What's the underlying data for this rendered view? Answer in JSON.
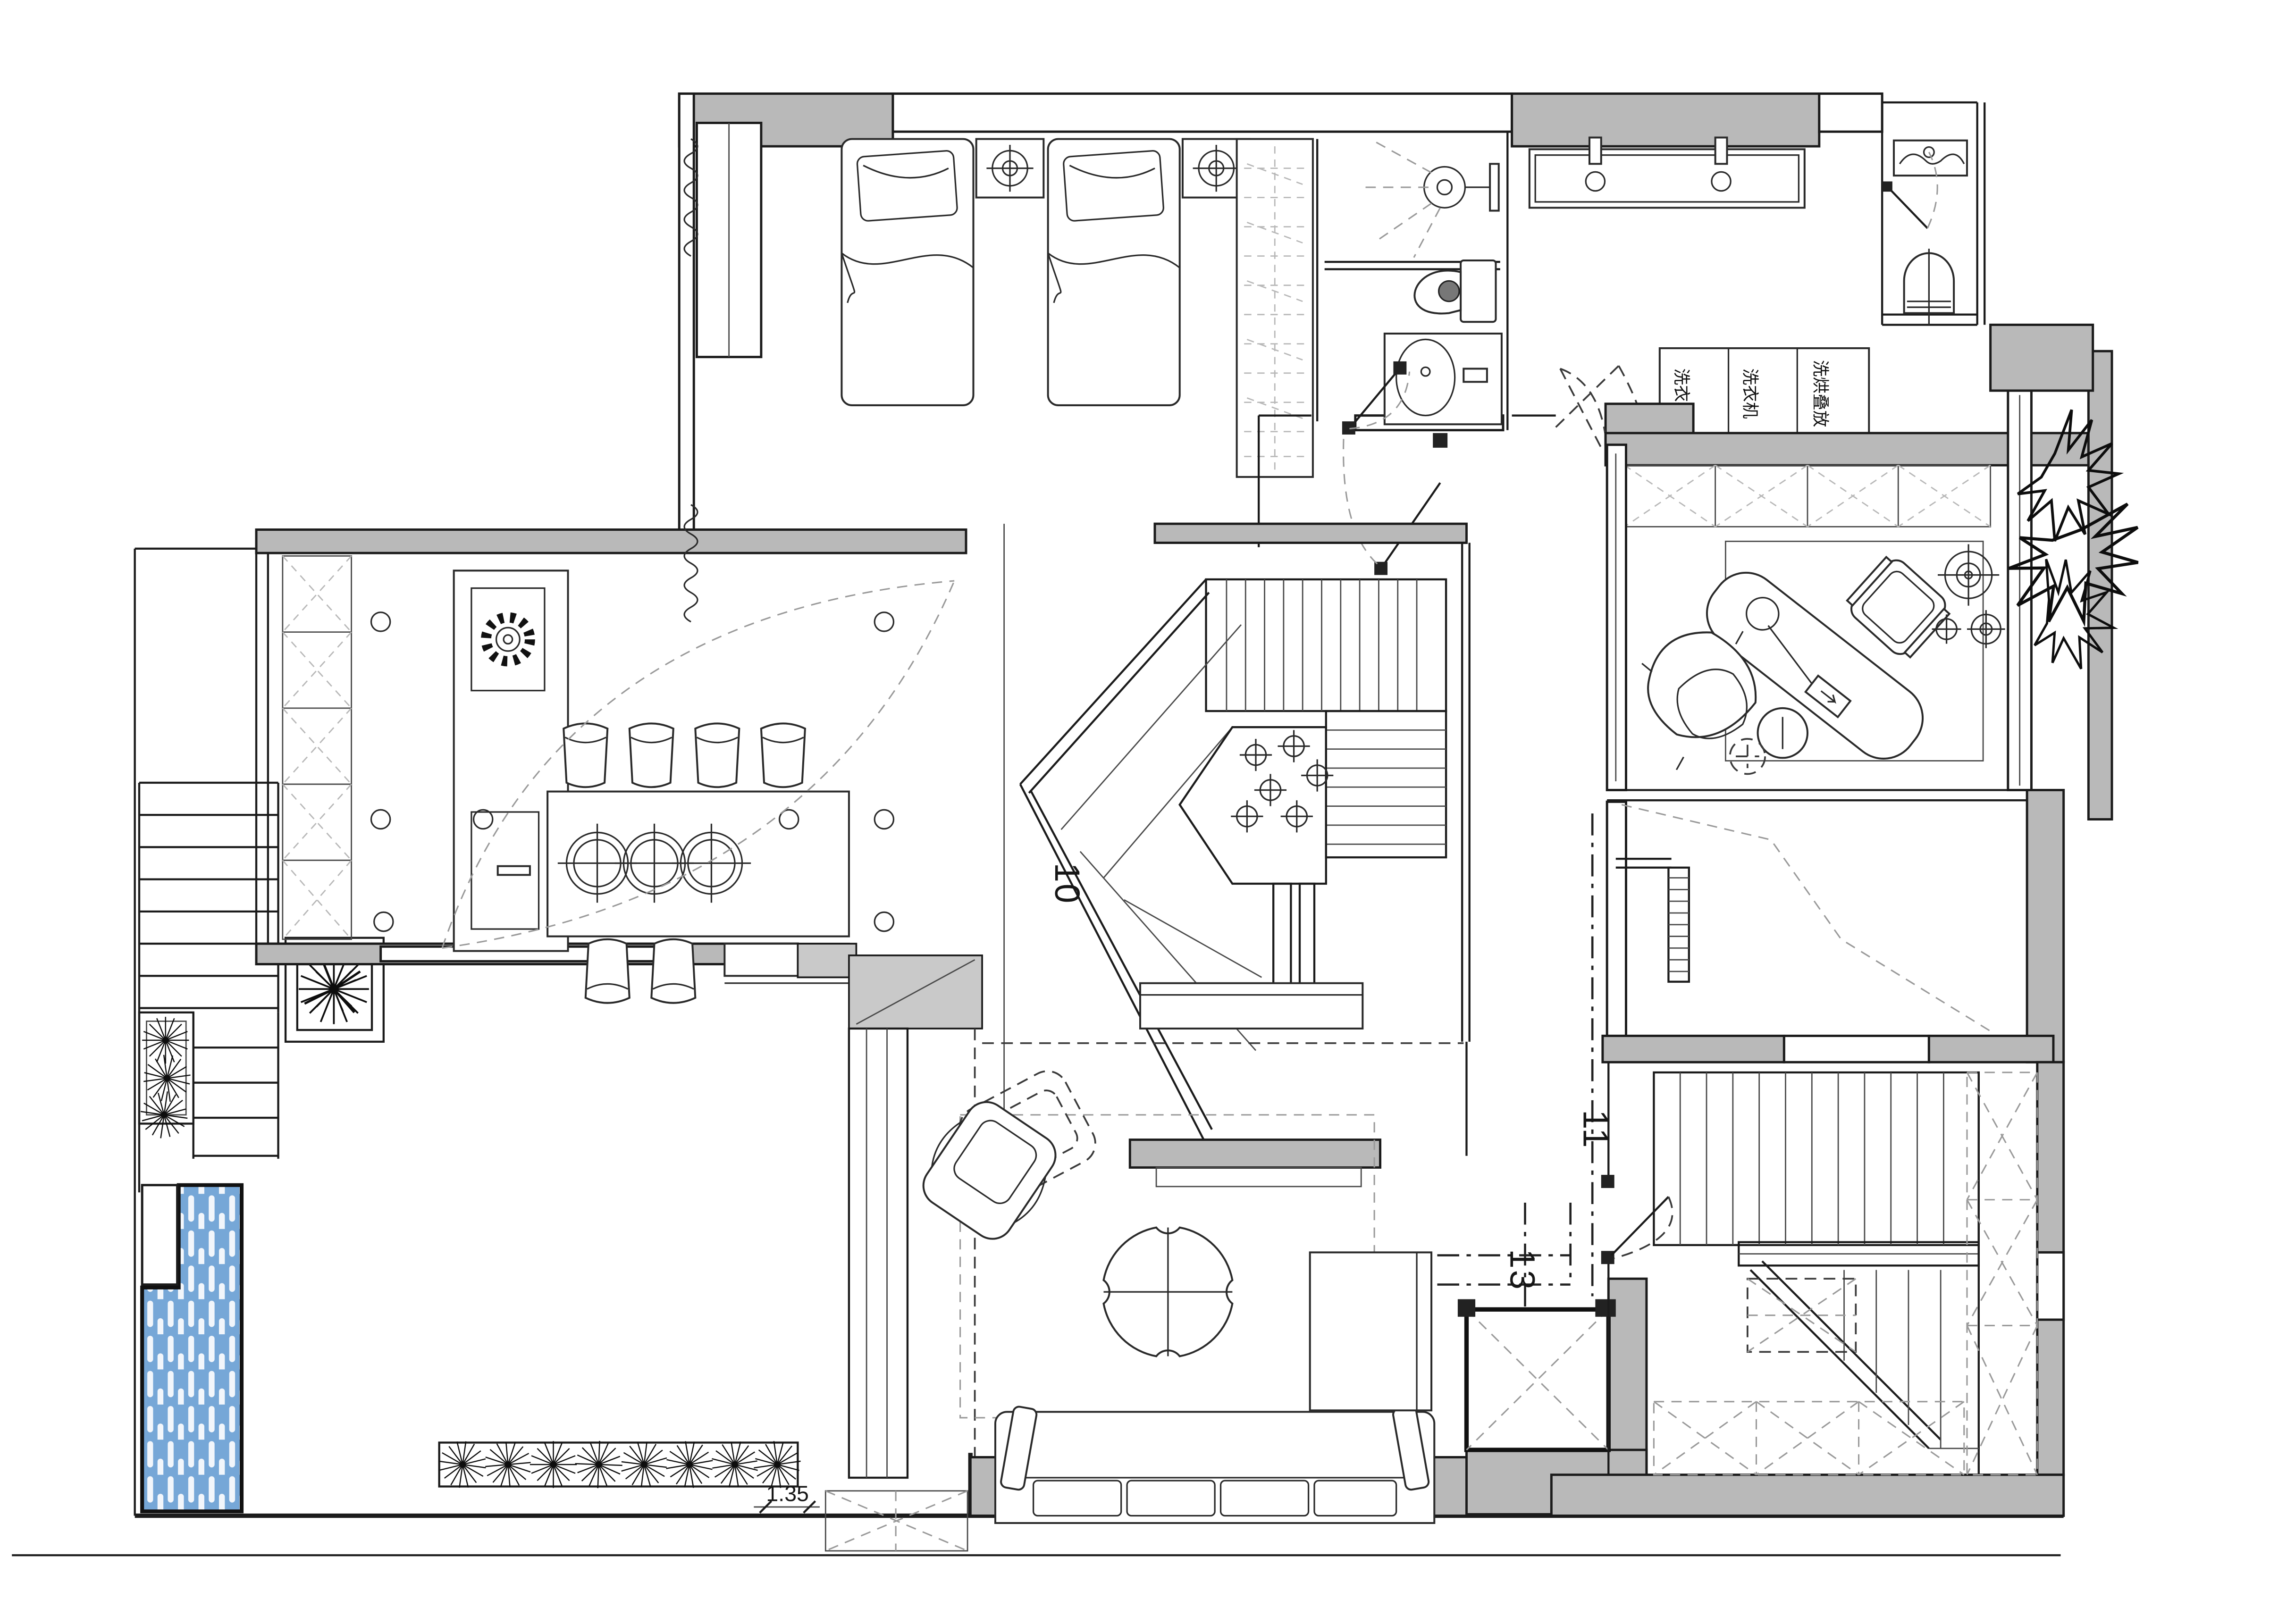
{
  "document": {
    "type": "architectural-floor-plan",
    "background": "#ffffff"
  },
  "colors": {
    "wall-fill": "#b9b9b9",
    "wall-light": "#c9c9c9",
    "line": "#1b1b1b",
    "pool-fill": "#76a7d7",
    "dash": "#9a9a9a"
  },
  "labels": {
    "upper_stair_number": "10",
    "lower_stair_number": "11",
    "elevator_zone_number": "13",
    "pond_dimension": "1.35",
    "laundry_unit_1": "洗衣机",
    "laundry_unit_2": "洗衣机",
    "laundry_unit_3": "洗烘叠放"
  }
}
